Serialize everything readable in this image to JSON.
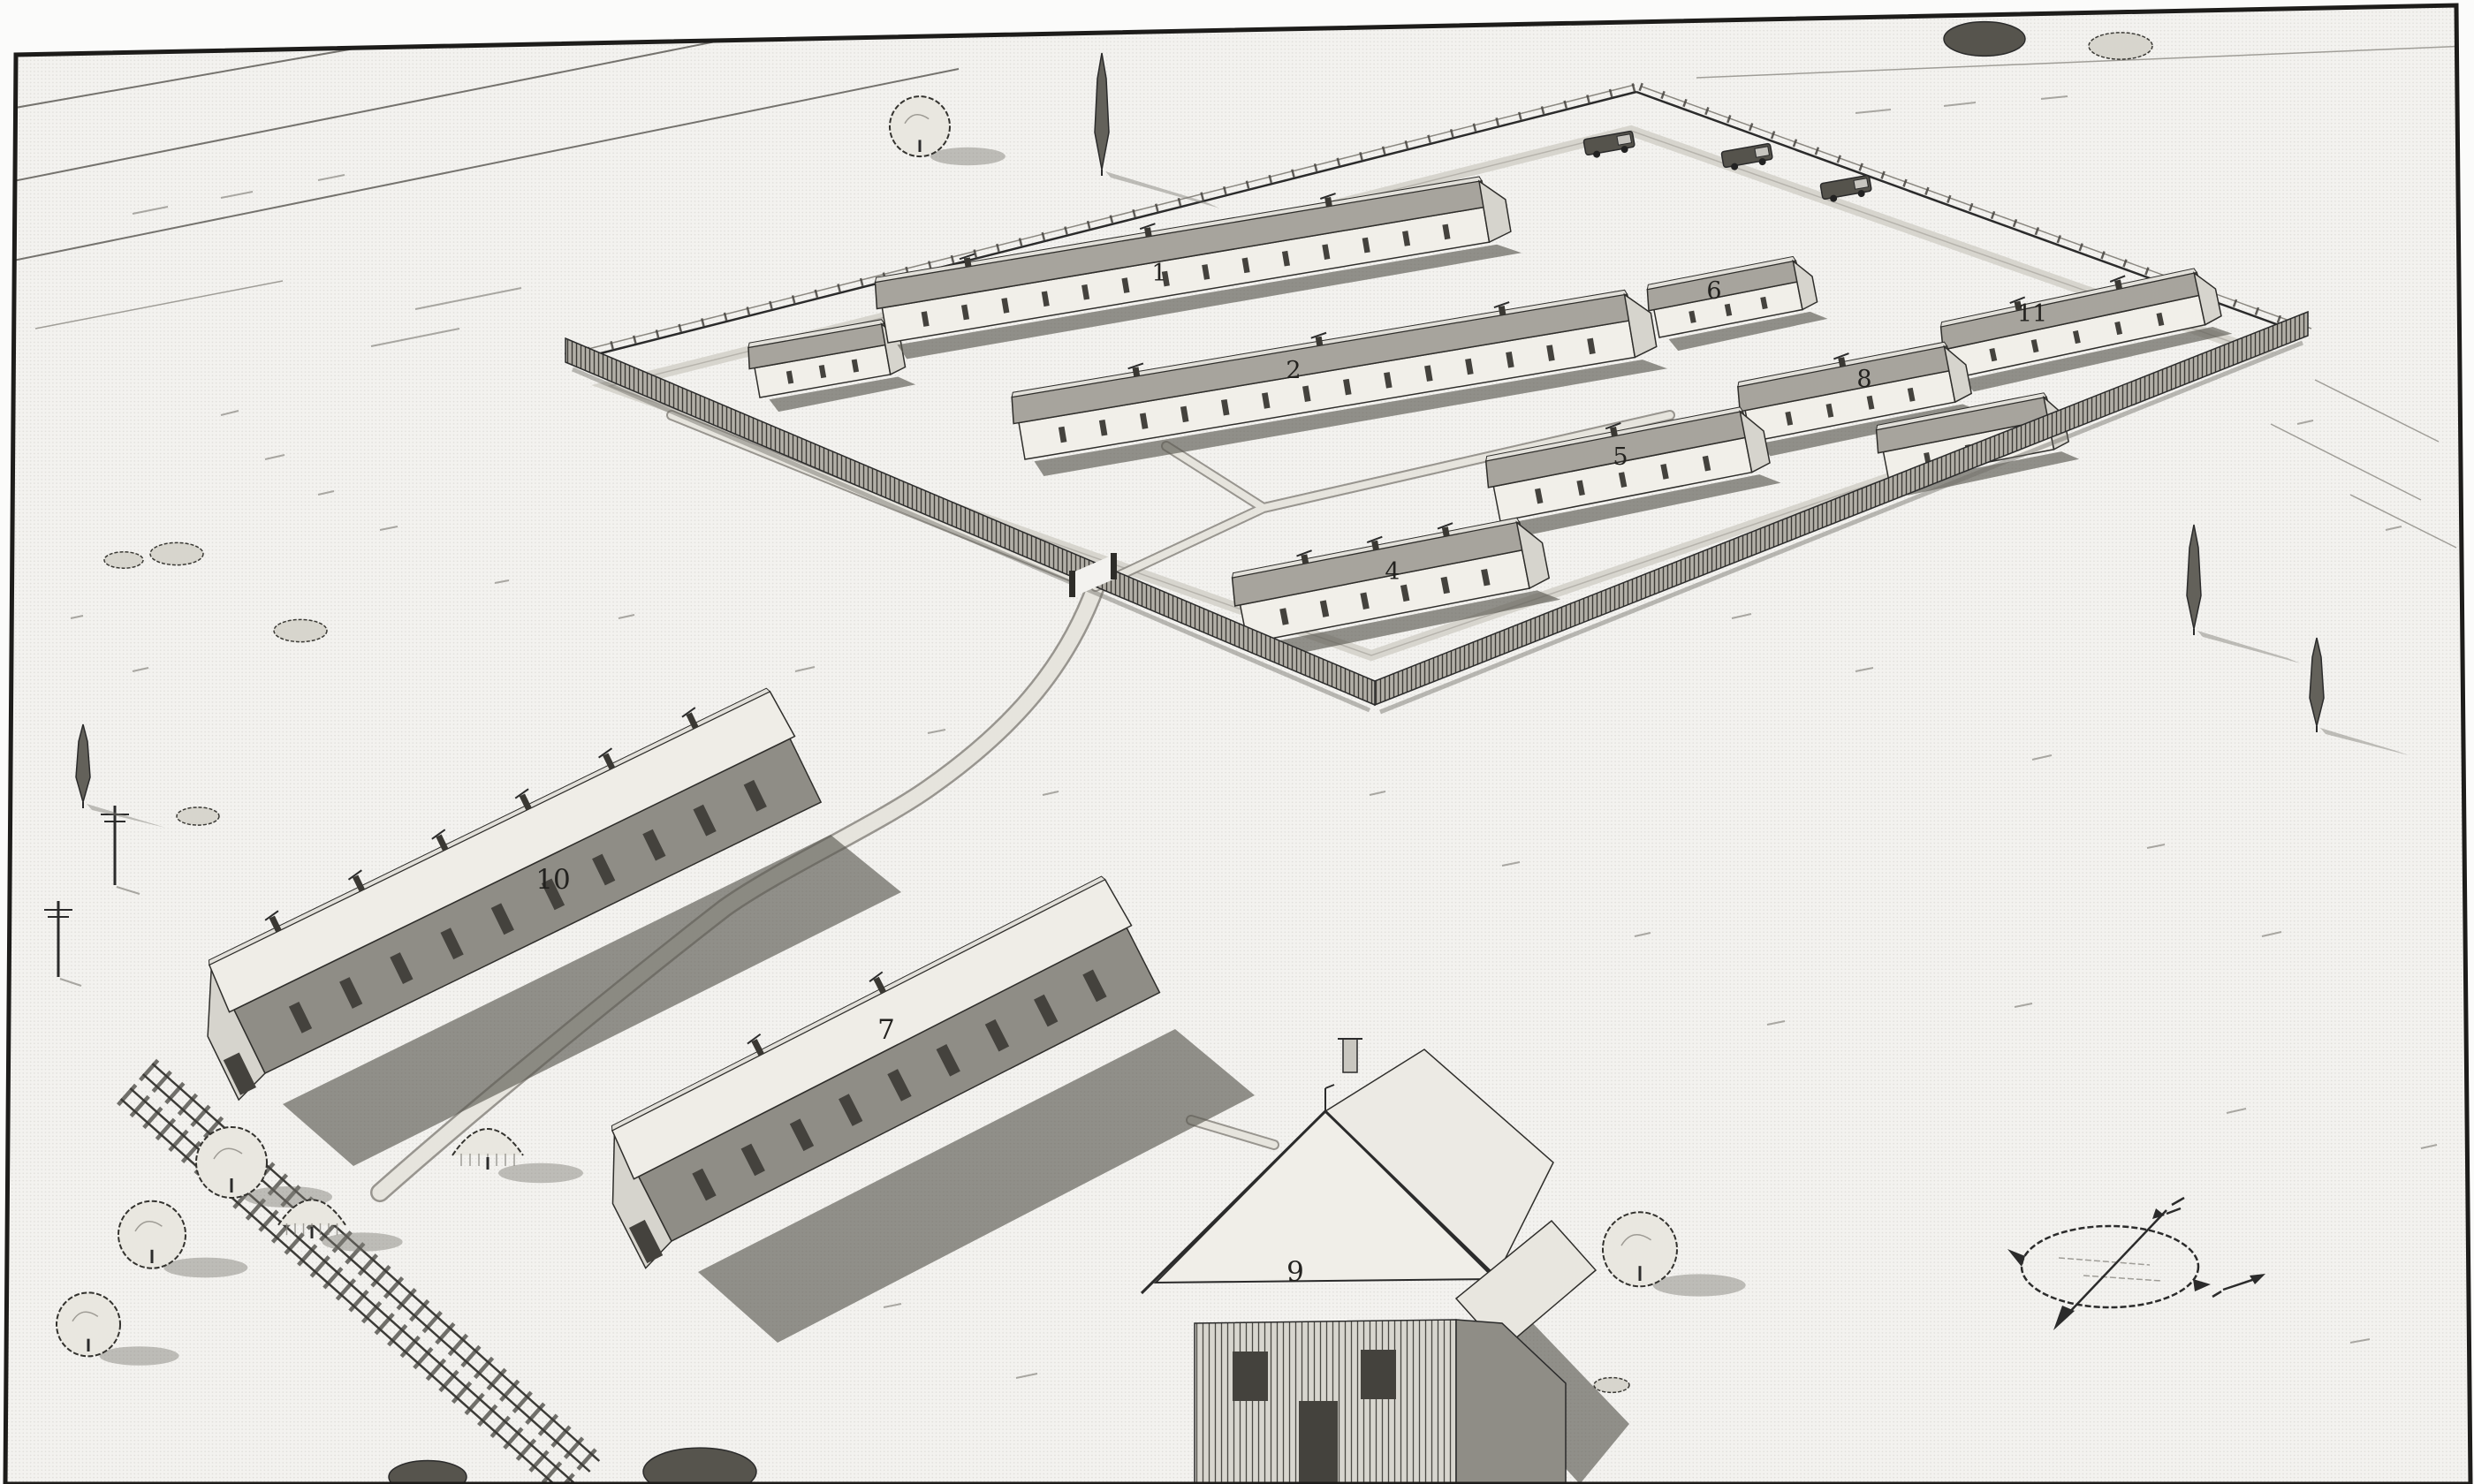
{
  "figure": {
    "palette": {
      "paper": "#f3f2ef",
      "ink": "#2b2b2b",
      "roof_shade": "#a7a49d",
      "wall_dark": "#8f8d86",
      "shadow": "#5b5951"
    },
    "compass_icon": "compass-rose"
  },
  "buildings": [
    {
      "name": "barracks-1",
      "label": "1"
    },
    {
      "name": "barracks-2",
      "label": "2"
    },
    {
      "name": "building-4",
      "label": "4"
    },
    {
      "name": "building-5",
      "label": "5"
    },
    {
      "name": "building-6",
      "label": "6"
    },
    {
      "name": "building-7",
      "label": "7"
    },
    {
      "name": "building-8",
      "label": "8"
    },
    {
      "name": "house-9",
      "label": "9"
    },
    {
      "name": "barracks-10",
      "label": "10"
    },
    {
      "name": "building-11",
      "label": "11"
    }
  ]
}
